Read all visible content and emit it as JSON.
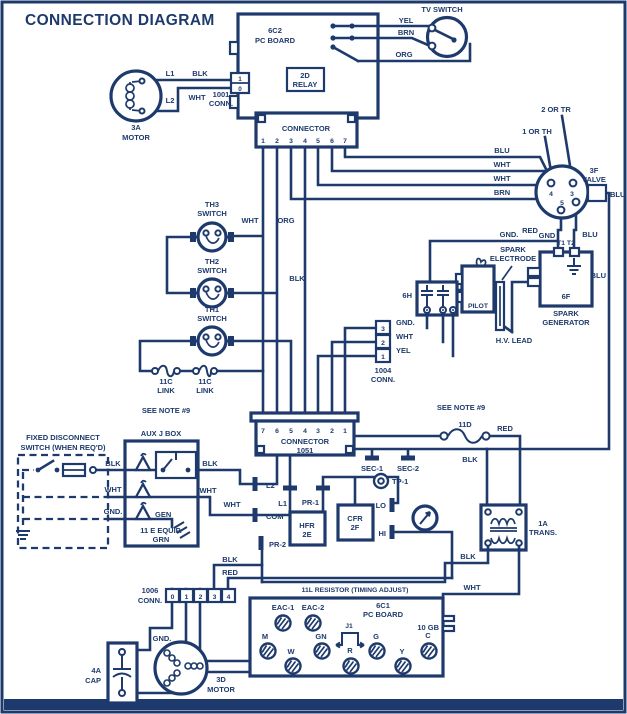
{
  "title": "CONNECTION DIAGRAM",
  "colors": {
    "ink": "#1e3a6c",
    "bg": "#ffffff"
  },
  "wire": {
    "blk": "BLK",
    "wht": "WHT",
    "yel": "YEL",
    "brn": "BRN",
    "org": "ORG",
    "blu": "BLU",
    "red": "RED",
    "gnd": "GND.",
    "gnd_plain": "GND"
  },
  "tv": {
    "name": "TV SWITCH"
  },
  "pcb6c2": {
    "l1": "6C2",
    "l2": "PC BOARD",
    "relay1": "2D",
    "relay2": "RELAY",
    "connector": "CONNECTOR",
    "pins": [
      "1",
      "2",
      "3",
      "4",
      "5",
      "6",
      "7"
    ]
  },
  "motor3a": {
    "l1": "L1",
    "l2": "L2",
    "conn1": "1001",
    "conn2": "CONN.",
    "pin1": "1",
    "pin0": "0",
    "name1": "3A",
    "name2": "MOTOR"
  },
  "valve": {
    "th": "1 OR TH",
    "tr": "2 OR TR",
    "name1": "3F",
    "name2": "VALVE",
    "p4": "4",
    "p3": "3",
    "p5": "5"
  },
  "spark": {
    "t1t2": "T1 T2",
    "el1": "SPARK",
    "el2": "ELECTRODE",
    "f": "6F",
    "g1": "SPARK",
    "g2": "GENERATOR",
    "hv": "H.V. LEAD",
    "pilot": "PILOT",
    "h": "6H"
  },
  "conn1004": {
    "pins": [
      "3",
      "2",
      "1"
    ],
    "n1": "1004",
    "n2": "CONN."
  },
  "th": {
    "th3": "TH3",
    "th2": "TH2",
    "th1": "TH1",
    "sw": "SWITCH",
    "link": "11C",
    "link2": "LINK"
  },
  "note": "SEE NOTE #9",
  "conn1051": {
    "n1": "CONNECTOR",
    "n2": "1051",
    "pins": [
      "7",
      "6",
      "5",
      "4",
      "3",
      "2",
      "1"
    ]
  },
  "disc": {
    "l1": "FIXED DISCONNECT",
    "l2": "SWITCH (WHEN REQ'D)"
  },
  "aux": {
    "name": "AUX J BOX",
    "gen": "GEN",
    "equip": "11 E EQUIP.",
    "grn": "GRN"
  },
  "ctrl": {
    "l2": "L2",
    "com": "COM",
    "pr2": "PR-2",
    "l1": "L1",
    "pr1": "PR-1",
    "hfr1": "HFR",
    "hfr2": "2E",
    "cfr1": "CFR",
    "cfr2": "2F",
    "lo": "LO",
    "hi": "HI",
    "sec1": "SEC-1",
    "sec2": "SEC-2",
    "tp1": "TP-1"
  },
  "right": {
    "d11": "11D",
    "trans1": "1A",
    "trans2": "TRANS."
  },
  "bottom": {
    "res": "11L RESISTOR (TIMING ADJUST)",
    "conn1": "1006",
    "conn2": "CONN.",
    "pins": [
      "0",
      "1",
      "2",
      "3",
      "4"
    ],
    "cap1": "4A",
    "cap2": "CAP",
    "mot1": "3D",
    "mot2": "MOTOR",
    "gnd": "GND."
  },
  "pcb6c1": {
    "n1": "6C1",
    "n2": "PC BOARD",
    "gb": "10 GB",
    "j1": "J1",
    "t": [
      "EAC-1",
      "EAC-2",
      "M",
      "W",
      "GN",
      "R",
      "G",
      "Y",
      "C"
    ]
  }
}
